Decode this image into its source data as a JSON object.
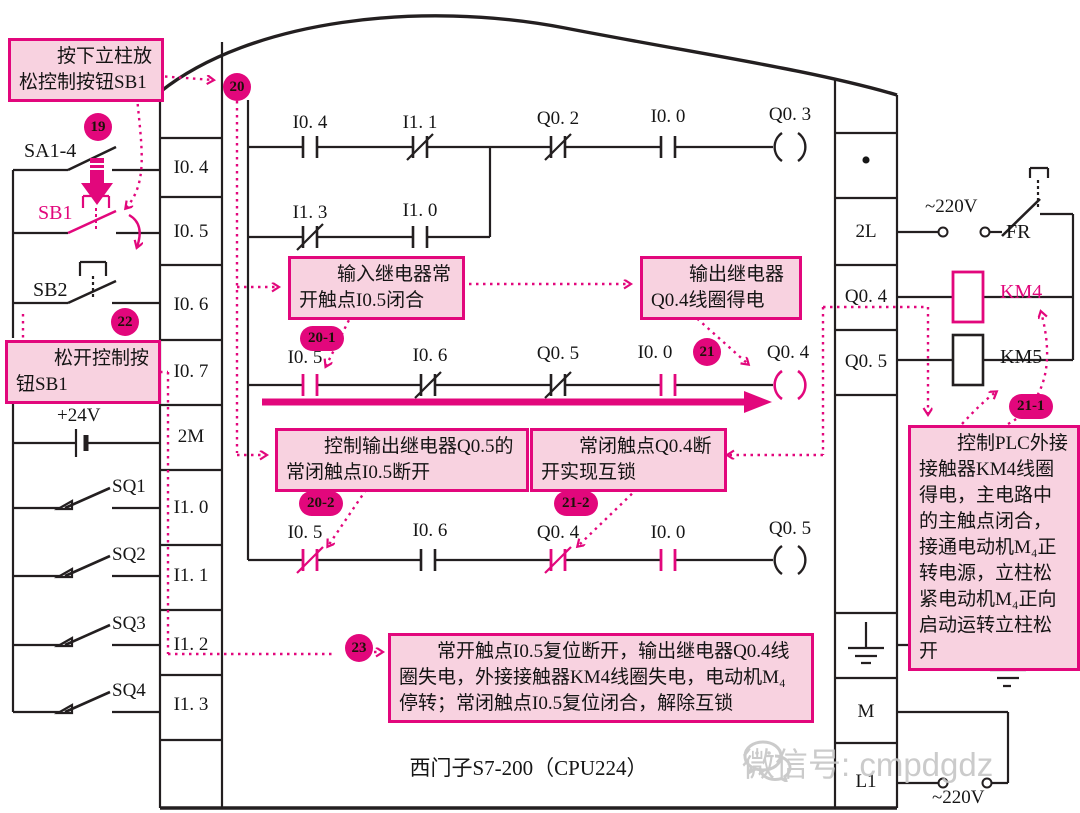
{
  "colors": {
    "accent": "#e2077c",
    "box_fill": "#f8d2e0",
    "wire": "#231f20",
    "watermark_gray": "#c6c6c6"
  },
  "plc": {
    "model_label": "西门子S7-200（CPU224）"
  },
  "watermark": {
    "text": "微信号: cmpdgdz"
  },
  "input_terminals": [
    "I0. 4",
    "I0. 5",
    "I0. 6",
    "I0. 7",
    "2M",
    "I1. 0",
    "I1. 1",
    "I1. 2",
    "I1. 3"
  ],
  "output_terminals": {
    "dot": "•",
    "t2l": "2L",
    "q04": "Q0. 4",
    "q05": "Q0. 5",
    "m": "M",
    "l1": "L1"
  },
  "left_field": {
    "sa1_4": "SA1-4",
    "sb1": "SB1",
    "sb2": "SB2",
    "plus24v": "+24V",
    "sq1": "SQ1",
    "sq2": "SQ2",
    "sq3": "SQ3",
    "sq4": "SQ4"
  },
  "right_field": {
    "ac_top": "~220V",
    "fr": "FR",
    "km4": "KM4",
    "km5": "KM5",
    "ac_bottom": "~220V"
  },
  "ladder": {
    "rung1": {
      "c1": "I0. 4",
      "c2": "I1. 1",
      "c3": "Q0. 2",
      "c4": "I0. 0",
      "coil": "Q0. 3"
    },
    "rung1_branch": {
      "c1": "I1. 3",
      "c2": "I1. 0"
    },
    "rung2": {
      "c1": "I0. 5",
      "c2": "I0. 6",
      "c3": "Q0. 5",
      "c4": "I0. 0",
      "coil": "Q0. 4"
    },
    "rung3": {
      "c1": "I0. 5",
      "c2": "I0. 6",
      "c3": "Q0. 4",
      "c4": "I0. 0",
      "coil": "Q0. 5"
    }
  },
  "badges": {
    "n19": "19",
    "n20": "20",
    "n20_1": "20-1",
    "n20_2": "20-2",
    "n21": "21",
    "n21_1": "21-1",
    "n21_2": "21-2",
    "n22": "22",
    "n23": "23"
  },
  "callouts": {
    "press_sb1": "按下立柱放松控制按钮SB1",
    "release_sb1": "松开控制按钮SB1",
    "input_relay_close": "输入继电器常开触点I0.5闭合",
    "output_relay_energize": "输出继电器Q0.4线圈得电",
    "q05_nc_open": "控制输出继电器Q0.5的常闭触点I0.5断开",
    "q04_interlock": "常闭触点Q0.4断开实现互锁",
    "reset_sequence": "常开触点I0.5复位断开，输出继电器Q0.4线圈失电，外接接触器KM4线圈失电，电动机M₄停转；常闭触点I0.5复位闭合，解除互锁",
    "km4_action": "控制PLC外接接触器KM4线圈得电，主电路中的主触点闭合，接通电动机M₄正转电源，立柱松紧电动机M₄正向启动运转立柱松开"
  }
}
